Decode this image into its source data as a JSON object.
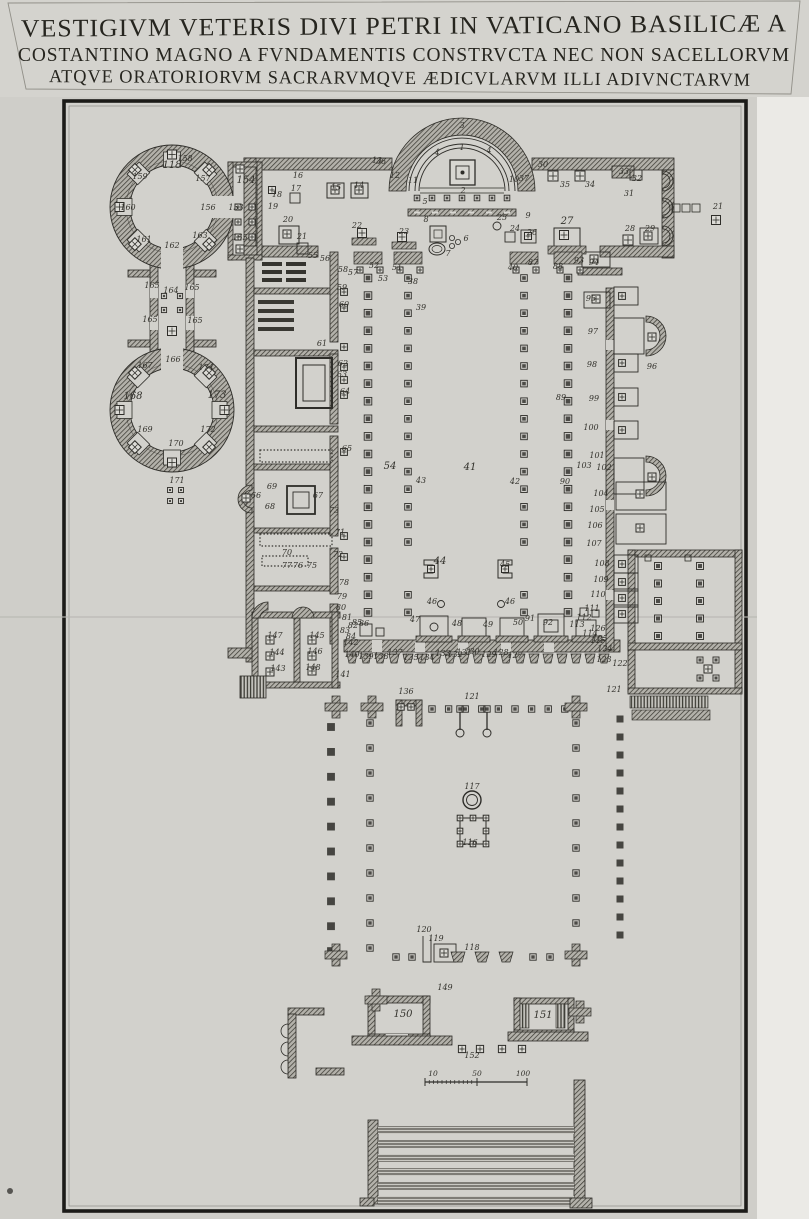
{
  "title": {
    "line1": "VESTIGIVM VETERIS DIVI PETRI IN VATICANO BASILICÆ A",
    "line2": "COSTANTINO MAGNO A FVNDAMENTIS CONSTRVCTA NEC NON SACELLORVM",
    "line3": "ATQVE ORATORIORVM SACRARVMQVE ÆDICVLARVM ILLI ADIVNCTARVM"
  },
  "plan": {
    "ink": "#2e2d29",
    "paper": "#d2d1cc",
    "scale_bar": {
      "y": 1076,
      "labels": [
        {
          "t": "10",
          "x": 433
        },
        {
          "t": "50",
          "x": 477
        },
        {
          "t": "100",
          "x": 523
        }
      ]
    },
    "labels": [
      {
        "t": "1",
        "x": 462,
        "y": 150
      },
      {
        "t": "2",
        "x": 463,
        "y": 193
      },
      {
        "t": "3",
        "x": 462,
        "y": 128
      },
      {
        "t": "4",
        "x": 437,
        "y": 155
      },
      {
        "t": "4",
        "x": 489,
        "y": 153
      },
      {
        "t": "5",
        "x": 425,
        "y": 204
      },
      {
        "t": "6",
        "x": 466,
        "y": 241
      },
      {
        "t": "7",
        "x": 448,
        "y": 256
      },
      {
        "t": "8",
        "x": 426,
        "y": 222
      },
      {
        "t": "9",
        "x": 528,
        "y": 218
      },
      {
        "t": "10",
        "x": 514,
        "y": 182
      },
      {
        "t": "11",
        "x": 413,
        "y": 183
      },
      {
        "t": "12",
        "x": 395,
        "y": 178
      },
      {
        "t": "13",
        "x": 377,
        "y": 163
      },
      {
        "t": "14",
        "x": 359,
        "y": 188
      },
      {
        "t": "15",
        "x": 336,
        "y": 190
      },
      {
        "t": "16",
        "x": 298,
        "y": 178
      },
      {
        "t": "17",
        "x": 296,
        "y": 191
      },
      {
        "t": "18",
        "x": 277,
        "y": 197
      },
      {
        "t": "19",
        "x": 273,
        "y": 209
      },
      {
        "t": "20",
        "x": 288,
        "y": 222
      },
      {
        "t": "21",
        "x": 302,
        "y": 239
      },
      {
        "t": "21",
        "x": 718,
        "y": 209
      },
      {
        "t": "22",
        "x": 357,
        "y": 228
      },
      {
        "t": "23",
        "x": 404,
        "y": 234
      },
      {
        "t": "24",
        "x": 515,
        "y": 231
      },
      {
        "t": "25",
        "x": 502,
        "y": 220
      },
      {
        "t": "26",
        "x": 532,
        "y": 235
      },
      {
        "t": "27",
        "x": 567,
        "y": 224,
        "s": 10
      },
      {
        "t": "28",
        "x": 630,
        "y": 231
      },
      {
        "t": "29",
        "x": 650,
        "y": 231
      },
      {
        "t": "30",
        "x": 543,
        "y": 167
      },
      {
        "t": "31",
        "x": 629,
        "y": 196
      },
      {
        "t": "32",
        "x": 637,
        "y": 181
      },
      {
        "t": "33",
        "x": 624,
        "y": 174
      },
      {
        "t": "34",
        "x": 590,
        "y": 187
      },
      {
        "t": "35",
        "x": 565,
        "y": 187
      },
      {
        "t": "36",
        "x": 381,
        "y": 164
      },
      {
        "t": "37",
        "x": 524,
        "y": 181
      },
      {
        "t": "38",
        "x": 413,
        "y": 284
      },
      {
        "t": "39",
        "x": 421,
        "y": 310
      },
      {
        "t": "40",
        "x": 513,
        "y": 270
      },
      {
        "t": "41",
        "x": 470,
        "y": 470,
        "s": 10
      },
      {
        "t": "42",
        "x": 515,
        "y": 484
      },
      {
        "t": "43",
        "x": 421,
        "y": 483
      },
      {
        "t": "44",
        "x": 440,
        "y": 564,
        "s": 10
      },
      {
        "t": "45",
        "x": 505,
        "y": 567
      },
      {
        "t": "46",
        "x": 432,
        "y": 604
      },
      {
        "t": "46",
        "x": 510,
        "y": 604
      },
      {
        "t": "47",
        "x": 415,
        "y": 622
      },
      {
        "t": "48",
        "x": 457,
        "y": 626
      },
      {
        "t": "49",
        "x": 488,
        "y": 627
      },
      {
        "t": "50",
        "x": 518,
        "y": 625
      },
      {
        "t": "51",
        "x": 397,
        "y": 270
      },
      {
        "t": "52",
        "x": 374,
        "y": 268
      },
      {
        "t": "53",
        "x": 383,
        "y": 281
      },
      {
        "t": "54",
        "x": 390,
        "y": 469,
        "s": 10
      },
      {
        "t": "55",
        "x": 313,
        "y": 258
      },
      {
        "t": "56",
        "x": 325,
        "y": 261
      },
      {
        "t": "57",
        "x": 353,
        "y": 275
      },
      {
        "t": "58",
        "x": 343,
        "y": 272
      },
      {
        "t": "59",
        "x": 342,
        "y": 290
      },
      {
        "t": "60",
        "x": 344,
        "y": 307
      },
      {
        "t": "61",
        "x": 322,
        "y": 346
      },
      {
        "t": "62",
        "x": 343,
        "y": 366
      },
      {
        "t": "63",
        "x": 342,
        "y": 377
      },
      {
        "t": "64",
        "x": 345,
        "y": 394
      },
      {
        "t": "65",
        "x": 347,
        "y": 451
      },
      {
        "t": "66",
        "x": 256,
        "y": 498
      },
      {
        "t": "67",
        "x": 318,
        "y": 498
      },
      {
        "t": "68",
        "x": 270,
        "y": 509
      },
      {
        "t": "69",
        "x": 272,
        "y": 489
      },
      {
        "t": "70",
        "x": 287,
        "y": 555
      },
      {
        "t": "71",
        "x": 340,
        "y": 535
      },
      {
        "t": "72",
        "x": 338,
        "y": 557
      },
      {
        "t": "73",
        "x": 334,
        "y": 513
      },
      {
        "t": "75",
        "x": 312,
        "y": 568
      },
      {
        "t": "76",
        "x": 298,
        "y": 568
      },
      {
        "t": "77",
        "x": 287,
        "y": 568
      },
      {
        "t": "78",
        "x": 344,
        "y": 585
      },
      {
        "t": "79",
        "x": 342,
        "y": 599
      },
      {
        "t": "80",
        "x": 341,
        "y": 610
      },
      {
        "t": "81",
        "x": 347,
        "y": 620
      },
      {
        "t": "82",
        "x": 353,
        "y": 628
      },
      {
        "t": "83",
        "x": 345,
        "y": 633
      },
      {
        "t": "84",
        "x": 351,
        "y": 639
      },
      {
        "t": "85",
        "x": 357,
        "y": 625
      },
      {
        "t": "86",
        "x": 364,
        "y": 626
      },
      {
        "t": "87",
        "x": 533,
        "y": 265
      },
      {
        "t": "88",
        "x": 558,
        "y": 269
      },
      {
        "t": "89",
        "x": 561,
        "y": 400
      },
      {
        "t": "90",
        "x": 565,
        "y": 484
      },
      {
        "t": "91",
        "x": 530,
        "y": 621
      },
      {
        "t": "92",
        "x": 548,
        "y": 625
      },
      {
        "t": "93",
        "x": 579,
        "y": 263
      },
      {
        "t": "94",
        "x": 594,
        "y": 265
      },
      {
        "t": "95",
        "x": 591,
        "y": 301
      },
      {
        "t": "96",
        "x": 652,
        "y": 369
      },
      {
        "t": "97",
        "x": 593,
        "y": 334
      },
      {
        "t": "98",
        "x": 592,
        "y": 367
      },
      {
        "t": "99",
        "x": 594,
        "y": 401
      },
      {
        "t": "100",
        "x": 591,
        "y": 430
      },
      {
        "t": "101",
        "x": 597,
        "y": 458
      },
      {
        "t": "102",
        "x": 604,
        "y": 470
      },
      {
        "t": "103",
        "x": 584,
        "y": 468
      },
      {
        "t": "104",
        "x": 601,
        "y": 496
      },
      {
        "t": "105",
        "x": 597,
        "y": 512
      },
      {
        "t": "106",
        "x": 595,
        "y": 528
      },
      {
        "t": "107",
        "x": 594,
        "y": 546
      },
      {
        "t": "108",
        "x": 602,
        "y": 566
      },
      {
        "t": "109",
        "x": 601,
        "y": 582
      },
      {
        "t": "110",
        "x": 598,
        "y": 597
      },
      {
        "t": "111",
        "x": 592,
        "y": 611
      },
      {
        "t": "112",
        "x": 584,
        "y": 620
      },
      {
        "t": "113",
        "x": 577,
        "y": 627
      },
      {
        "t": "114",
        "x": 590,
        "y": 636
      },
      {
        "t": "115",
        "x": 598,
        "y": 643
      },
      {
        "t": "116",
        "x": 470,
        "y": 845
      },
      {
        "t": "117",
        "x": 472,
        "y": 789
      },
      {
        "t": "118",
        "x": 172,
        "y": 168,
        "s": 10
      },
      {
        "t": "118",
        "x": 472,
        "y": 950
      },
      {
        "t": "119",
        "x": 436,
        "y": 941
      },
      {
        "t": "120",
        "x": 424,
        "y": 932
      },
      {
        "t": "121",
        "x": 472,
        "y": 699
      },
      {
        "t": "121",
        "x": 614,
        "y": 692
      },
      {
        "t": "122",
        "x": 620,
        "y": 666
      },
      {
        "t": "123",
        "x": 604,
        "y": 662
      },
      {
        "t": "124",
        "x": 605,
        "y": 651
      },
      {
        "t": "125",
        "x": 600,
        "y": 641
      },
      {
        "t": "126",
        "x": 598,
        "y": 631
      },
      {
        "t": "127",
        "x": 515,
        "y": 658
      },
      {
        "t": "128",
        "x": 501,
        "y": 655
      },
      {
        "t": "129",
        "x": 489,
        "y": 657
      },
      {
        "t": "130",
        "x": 472,
        "y": 654
      },
      {
        "t": "131",
        "x": 464,
        "y": 655
      },
      {
        "t": "132",
        "x": 455,
        "y": 657
      },
      {
        "t": "133",
        "x": 443,
        "y": 656
      },
      {
        "t": "134",
        "x": 427,
        "y": 660
      },
      {
        "t": "135",
        "x": 411,
        "y": 660
      },
      {
        "t": "136",
        "x": 406,
        "y": 694
      },
      {
        "t": "137",
        "x": 395,
        "y": 655
      },
      {
        "t": "138",
        "x": 381,
        "y": 659
      },
      {
        "t": "139",
        "x": 366,
        "y": 659
      },
      {
        "t": "140",
        "x": 352,
        "y": 657
      },
      {
        "t": "141",
        "x": 343,
        "y": 677
      },
      {
        "t": "142",
        "x": 351,
        "y": 645
      },
      {
        "t": "143",
        "x": 278,
        "y": 671
      },
      {
        "t": "144",
        "x": 277,
        "y": 655
      },
      {
        "t": "145",
        "x": 317,
        "y": 638
      },
      {
        "t": "146",
        "x": 315,
        "y": 654
      },
      {
        "t": "147",
        "x": 275,
        "y": 638
      },
      {
        "t": "148",
        "x": 313,
        "y": 670
      },
      {
        "t": "149",
        "x": 445,
        "y": 990
      },
      {
        "t": "150",
        "x": 403,
        "y": 1017,
        "s": 10
      },
      {
        "t": "151",
        "x": 543,
        "y": 1018,
        "s": 10
      },
      {
        "t": "152",
        "x": 472,
        "y": 1058
      },
      {
        "t": "153",
        "x": 236,
        "y": 210
      },
      {
        "t": "154",
        "x": 246,
        "y": 183,
        "s": 10
      },
      {
        "t": "155",
        "x": 240,
        "y": 240
      },
      {
        "t": "156",
        "x": 208,
        "y": 210
      },
      {
        "t": "157",
        "x": 203,
        "y": 181
      },
      {
        "t": "158",
        "x": 185,
        "y": 161
      },
      {
        "t": "159",
        "x": 140,
        "y": 179
      },
      {
        "t": "160",
        "x": 128,
        "y": 210
      },
      {
        "t": "161",
        "x": 144,
        "y": 242
      },
      {
        "t": "162",
        "x": 172,
        "y": 248
      },
      {
        "t": "163",
        "x": 200,
        "y": 238
      },
      {
        "t": "164",
        "x": 171,
        "y": 293
      },
      {
        "t": "165",
        "x": 152,
        "y": 288
      },
      {
        "t": "165",
        "x": 192,
        "y": 290
      },
      {
        "t": "165",
        "x": 150,
        "y": 322
      },
      {
        "t": "165",
        "x": 195,
        "y": 323
      },
      {
        "t": "166",
        "x": 173,
        "y": 362
      },
      {
        "t": "167",
        "x": 145,
        "y": 368
      },
      {
        "t": "168",
        "x": 133,
        "y": 399,
        "s": 10
      },
      {
        "t": "169",
        "x": 145,
        "y": 432
      },
      {
        "t": "170",
        "x": 176,
        "y": 446
      },
      {
        "t": "171",
        "x": 177,
        "y": 483
      },
      {
        "t": "172",
        "x": 208,
        "y": 432
      },
      {
        "t": "173",
        "x": 217,
        "y": 398,
        "s": 10
      },
      {
        "t": "174",
        "x": 206,
        "y": 370
      }
    ]
  }
}
